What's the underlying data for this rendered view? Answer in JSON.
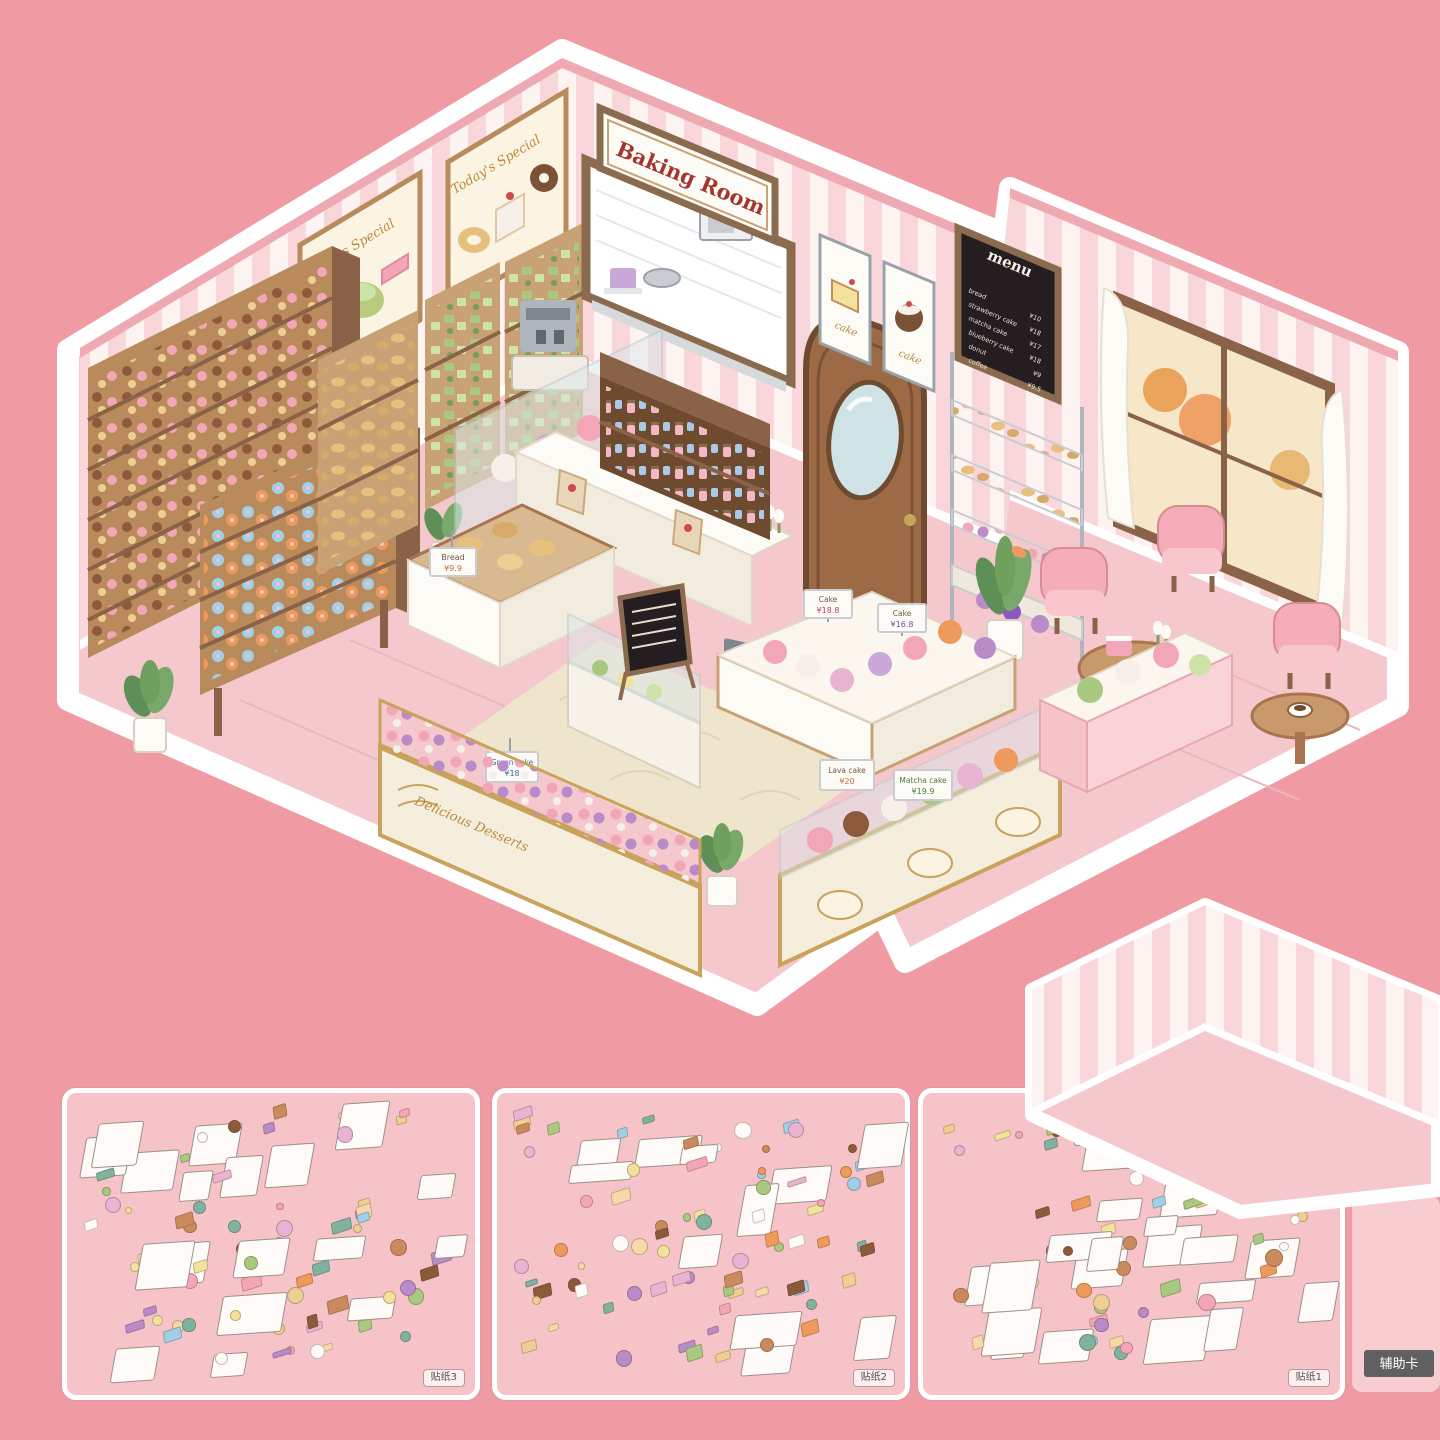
{
  "colors": {
    "bg": "#F09BA4",
    "sheet": "#F6C3C9",
    "stripeL": "#FDF3F1",
    "stripeP": "#F8D6DA",
    "floor": "#F4C8CD",
    "wood": "#A9744F",
    "woodD": "#6E4A2F",
    "gold": "#B98A3C",
    "chalk": "#241E20",
    "red": "#A43430",
    "rug": "#EFE5CC",
    "badge": "#606062"
  },
  "scene": {
    "baking_room_sign": "Baking Room",
    "todays_special_label_1": "Today's Special",
    "todays_special_label_2": "Today's Special",
    "doughnuts_poster_caption": "Cream Doughnuts",
    "cake_poster_label_1": "cake",
    "cake_poster_label_2": "cake",
    "gold_case_text": "Delicious Desserts",
    "menu_board": {
      "title": "menu",
      "items": [
        {
          "name": "bread",
          "price": "¥10"
        },
        {
          "name": "strawberry cake",
          "price": "¥18"
        },
        {
          "name": "matcha cake",
          "price": "¥17"
        },
        {
          "name": "blueberry cake",
          "price": "¥18"
        },
        {
          "name": "donut",
          "price": "¥9"
        },
        {
          "name": "coffee",
          "price": "¥9.5"
        }
      ]
    },
    "case_signs": {
      "bread": {
        "label": "Bread",
        "price": "¥9.9"
      },
      "green_cake": {
        "label": "Green cake",
        "price": "¥18"
      },
      "cake_left": {
        "label": "Cake",
        "price": "¥18.8"
      },
      "cake_right": {
        "label": "Cake",
        "price": "¥16.8"
      },
      "lava": {
        "label": "Lava cake",
        "price": "¥20"
      },
      "matcha": {
        "label": "Matcha cake",
        "price": "¥19.9"
      }
    }
  },
  "sheets": [
    {
      "label": "贴纸3",
      "seed": 3,
      "item_count": 82
    },
    {
      "label": "贴纸2",
      "seed": 7,
      "item_count": 88
    },
    {
      "label": "贴纸1",
      "seed": 11,
      "item_count": 74
    }
  ],
  "aux_card": {
    "badge": "辅助卡"
  },
  "palette_goods": [
    "#F5D9A8",
    "#EECF93",
    "#C98B5E",
    "#8C5A3B",
    "#F3A6B8",
    "#B98BC9",
    "#9FD0E8",
    "#A8C97F",
    "#F2E29B",
    "#E8B4D1",
    "#7FB3A0",
    "#EE9A5C",
    "#FDFAF7"
  ]
}
